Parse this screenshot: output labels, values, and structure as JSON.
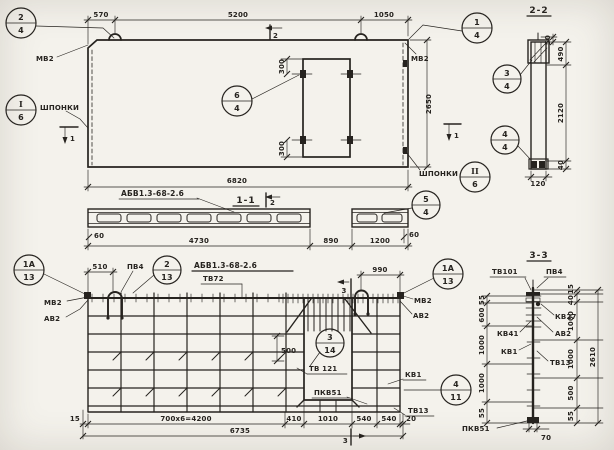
{
  "meta": {
    "paper": "#f4f2ec",
    "ink": "#26231f"
  },
  "main": {
    "dims": {
      "w1": "570",
      "w2": "5200",
      "w3": "1050",
      "height": "2650",
      "total": "6820",
      "open_top": "300",
      "open_bot": "300"
    },
    "marks": {
      "sec1": "1",
      "sec2": "2"
    },
    "labels": {
      "mv2": "МВ2",
      "shponki": "ШПОНКИ"
    },
    "callouts": {
      "c24": {
        "a": "2",
        "b": "4"
      },
      "c14": {
        "a": "1",
        "b": "4"
      },
      "c64": {
        "a": "6",
        "b": "4"
      },
      "ci6": {
        "a": "I",
        "b": "6"
      },
      "cii6": {
        "a": "II",
        "b": "6"
      }
    }
  },
  "sec22": {
    "title": "2-2",
    "dims": {
      "d50": "50",
      "d490": "490",
      "d2120": "2120",
      "d40": "40",
      "d120": "120"
    },
    "callouts": {
      "c34": {
        "a": "3",
        "b": "4"
      },
      "c44": {
        "a": "4",
        "b": "4"
      }
    }
  },
  "sec11": {
    "title": "1-1",
    "tag": "АБВ1.3-68-2.6",
    "mark2": "2",
    "dims": {
      "d60l": "60",
      "d4730": "4730",
      "d890": "890",
      "d1200": "1200",
      "d60r": "60"
    },
    "callouts": {
      "c54": {
        "a": "5",
        "b": "4"
      }
    }
  },
  "plan": {
    "title": "АБВ1.3-68-2.6",
    "subtitle": "ТВ72",
    "mark3": "3",
    "labels": {
      "pv4": "ПВ4",
      "mv2": "МВ2",
      "av2": "АВ2",
      "tv121": "ТВ 121",
      "kv1": "КВ1",
      "pkv51": "ПКВ51",
      "tv13": "ТВ13"
    },
    "dims": {
      "d510": "510",
      "d990": "990",
      "d500": "500",
      "d15": "15",
      "d4200": "700х6=4200",
      "d410": "410",
      "d1010": "1010",
      "d540a": "540",
      "d540b": "540",
      "d20": "20",
      "total": "6735"
    },
    "callouts": {
      "c1a13l": {
        "a": "1А",
        "b": "13"
      },
      "c213": {
        "a": "2",
        "b": "13"
      },
      "c1a13r": {
        "a": "1А",
        "b": "13"
      },
      "c314": {
        "a": "3",
        "b": "14"
      },
      "c411": {
        "a": "4",
        "b": "11"
      }
    }
  },
  "sec33": {
    "title": "3-3",
    "labels": {
      "tv101": "ТВ101",
      "pv4": "ПВ4",
      "kv27": "КВ27",
      "av2": "АВ2",
      "kv41": "КВ41",
      "kv1": "КВ1",
      "tv13": "ТВ13",
      "pkv51": "ПКВ51"
    },
    "dims": {
      "l55t": "55",
      "l600": "600",
      "l1000a": "1000",
      "l1000b": "1000",
      "l55b": "55",
      "r15": "15",
      "r40": "40",
      "r1000a": "1000",
      "r1000b": "1000",
      "r500": "500",
      "r55": "55",
      "r2610": "2610",
      "d70": "70"
    }
  }
}
